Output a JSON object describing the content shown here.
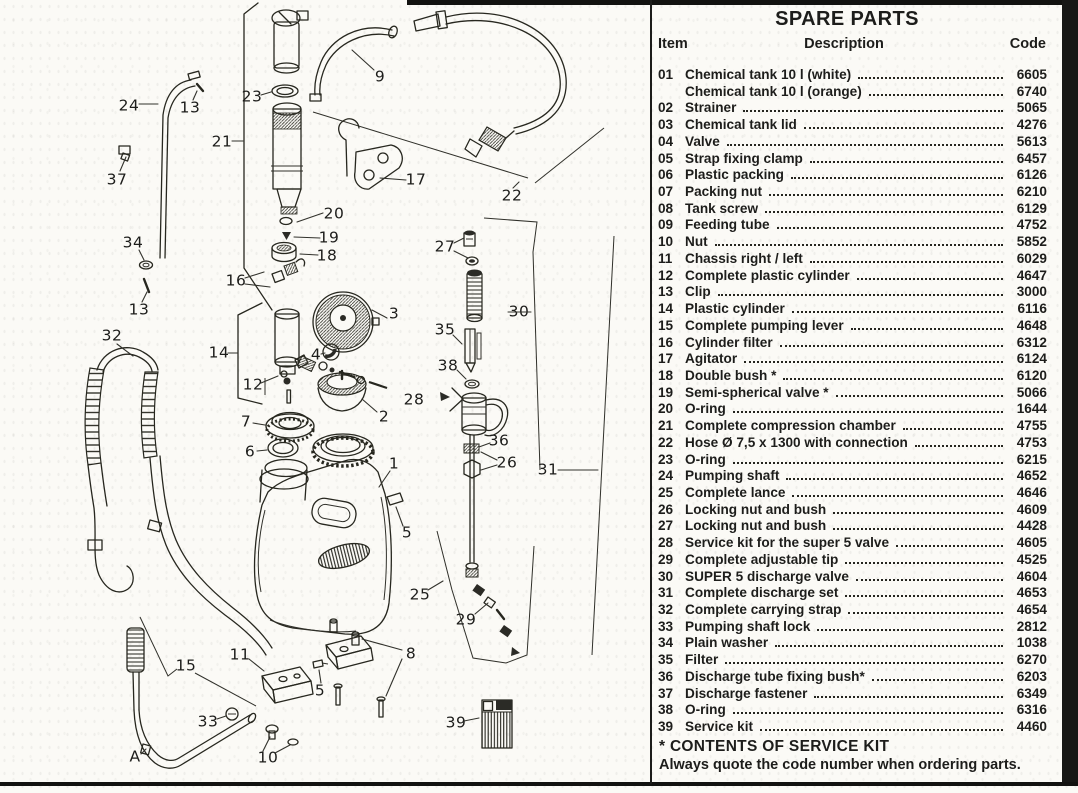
{
  "colors": {
    "ink": "#1d1d1b",
    "paper": "#fbfaf6"
  },
  "parts_table": {
    "title": "SPARE PARTS",
    "columns": {
      "item": "Item",
      "description": "Description",
      "code": "Code"
    },
    "rows": [
      {
        "item": "01",
        "description": "Chemical tank 10 l (white)",
        "code": "6605"
      },
      {
        "item": "",
        "description": "Chemical tank 10 l (orange)",
        "code": "6740"
      },
      {
        "item": "02",
        "description": "Strainer",
        "code": "5065"
      },
      {
        "item": "03",
        "description": "Chemical tank lid",
        "code": "4276"
      },
      {
        "item": "04",
        "description": "Valve",
        "code": "5613"
      },
      {
        "item": "05",
        "description": "Strap fixing clamp",
        "code": "6457"
      },
      {
        "item": "06",
        "description": "Plastic packing",
        "code": "6126"
      },
      {
        "item": "07",
        "description": "Packing nut",
        "code": "6210"
      },
      {
        "item": "08",
        "description": "Tank screw",
        "code": "6129"
      },
      {
        "item": "09",
        "description": "Feeding tube",
        "code": "4752"
      },
      {
        "item": "10",
        "description": "Nut",
        "code": "5852"
      },
      {
        "item": "11",
        "description": "Chassis right / left",
        "code": "6029"
      },
      {
        "item": "12",
        "description": "Complete plastic cylinder",
        "code": "4647"
      },
      {
        "item": "13",
        "description": "Clip",
        "code": "3000"
      },
      {
        "item": "14",
        "description": "Plastic cylinder",
        "code": "6116"
      },
      {
        "item": "15",
        "description": "Complete pumping lever",
        "code": "4648"
      },
      {
        "item": "16",
        "description": "Cylinder filter",
        "code": "6312"
      },
      {
        "item": "17",
        "description": "Agitator",
        "code": "6124"
      },
      {
        "item": "18",
        "description": "Double bush *",
        "code": "6120"
      },
      {
        "item": "19",
        "description": "Semi-spherical valve *",
        "code": "5066"
      },
      {
        "item": "20",
        "description": "O-ring",
        "code": "1644"
      },
      {
        "item": "21",
        "description": "Complete compression chamber",
        "code": "4755"
      },
      {
        "item": "22",
        "description": "Hose Ø 7,5 x 1300 with connection",
        "code": "4753"
      },
      {
        "item": "23",
        "description": "O-ring",
        "code": "6215"
      },
      {
        "item": "24",
        "description": "Pumping shaft",
        "code": "4652"
      },
      {
        "item": "25",
        "description": "Complete lance",
        "code": "4646"
      },
      {
        "item": "26",
        "description": "Locking nut and bush",
        "code": "4609"
      },
      {
        "item": "27",
        "description": "Locking nut and bush",
        "code": "4428"
      },
      {
        "item": "28",
        "description": "Service kit for the super 5 valve",
        "code": "4605"
      },
      {
        "item": "29",
        "description": "Complete adjustable tip",
        "code": "4525"
      },
      {
        "item": "30",
        "description": "SUPER 5 discharge valve",
        "code": "4604"
      },
      {
        "item": "31",
        "description": "Complete discharge set",
        "code": "4653"
      },
      {
        "item": "32",
        "description": "Complete carrying strap",
        "code": "4654"
      },
      {
        "item": "33",
        "description": "Pumping shaft lock",
        "code": "2812"
      },
      {
        "item": "34",
        "description": "Plain washer",
        "code": "1038"
      },
      {
        "item": "35",
        "description": "Filter",
        "code": "6270"
      },
      {
        "item": "36",
        "description": "Discharge tube fixing bush*",
        "code": "6203"
      },
      {
        "item": "37",
        "description": "Discharge fastener",
        "code": "6349"
      },
      {
        "item": "38",
        "description": "O-ring",
        "code": "6316"
      },
      {
        "item": "39",
        "description": "Service kit",
        "code": "4460"
      }
    ],
    "footnote": "* CONTENTS OF SERVICE KIT",
    "note": "Always quote the code number when ordering parts."
  },
  "diagram": {
    "callouts": [
      {
        "t": "24",
        "x": 129,
        "y": 106,
        "l": [
          [
            139,
            104
          ],
          [
            158,
            104
          ]
        ]
      },
      {
        "t": "13",
        "x": 190,
        "y": 108,
        "l": [
          [
            193,
            100
          ],
          [
            197,
            91
          ]
        ]
      },
      {
        "t": "37",
        "x": 117,
        "y": 180,
        "l": [
          [
            120,
            171
          ],
          [
            126,
            157
          ]
        ]
      },
      {
        "t": "21",
        "x": 222,
        "y": 142,
        "l": [
          [
            232,
            141
          ],
          [
            243,
            141
          ]
        ]
      },
      {
        "t": "23",
        "x": 252,
        "y": 97,
        "l": [
          [
            261,
            95
          ],
          [
            271,
            92
          ]
        ]
      },
      {
        "t": "9",
        "x": 380,
        "y": 77,
        "l": [
          [
            374,
            70
          ],
          [
            352,
            50
          ]
        ]
      },
      {
        "t": "17",
        "x": 416,
        "y": 180,
        "l": [
          [
            406,
            180
          ],
          [
            380,
            178
          ]
        ]
      },
      {
        "t": "22",
        "x": 512,
        "y": 196,
        "l": [
          [
            513,
            188
          ],
          [
            519,
            182
          ]
        ]
      },
      {
        "t": "20",
        "x": 334,
        "y": 214,
        "l": [
          [
            323,
            213
          ],
          [
            297,
            222
          ]
        ]
      },
      {
        "t": "19",
        "x": 329,
        "y": 238,
        "l": [
          [
            320,
            238
          ],
          [
            294,
            237
          ]
        ]
      },
      {
        "t": "18",
        "x": 327,
        "y": 256,
        "l": [
          [
            318,
            255
          ],
          [
            300,
            254
          ]
        ]
      },
      {
        "t": "34",
        "x": 133,
        "y": 243,
        "l": [
          [
            139,
            250
          ],
          [
            144,
            260
          ]
        ]
      },
      {
        "t": "16",
        "x": 236,
        "y": 281,
        "l": [
          [
            245,
            278
          ],
          [
            264,
            272
          ]
        ],
        "l2": [
          [
            245,
            284
          ],
          [
            270,
            287
          ]
        ]
      },
      {
        "t": "27",
        "x": 445,
        "y": 247,
        "l": [
          [
            454,
            243
          ],
          [
            464,
            238
          ]
        ],
        "l2": [
          [
            454,
            251
          ],
          [
            468,
            258
          ]
        ]
      },
      {
        "t": "13",
        "x": 139,
        "y": 310,
        "l": [
          [
            142,
            302
          ],
          [
            147,
            292
          ]
        ]
      },
      {
        "t": "32",
        "x": 112,
        "y": 336,
        "l": [
          [
            117,
            344
          ],
          [
            133,
            356
          ]
        ]
      },
      {
        "t": "14",
        "x": 219,
        "y": 353,
        "l": [
          [
            228,
            353
          ],
          [
            238,
            353
          ]
        ]
      },
      {
        "t": "12",
        "x": 253,
        "y": 385,
        "l": [
          [
            261,
            383
          ],
          [
            278,
            376
          ]
        ]
      },
      {
        "t": "3",
        "x": 394,
        "y": 314,
        "l": [
          [
            387,
            318
          ],
          [
            372,
            310
          ]
        ]
      },
      {
        "t": "4",
        "x": 316,
        "y": 355,
        "l": [
          [
            321,
            354
          ],
          [
            325,
            353
          ]
        ]
      },
      {
        "t": "35",
        "x": 445,
        "y": 330,
        "l": [
          [
            453,
            335
          ],
          [
            462,
            344
          ]
        ]
      },
      {
        "t": "38",
        "x": 448,
        "y": 366,
        "l": [
          [
            457,
            370
          ],
          [
            466,
            379
          ]
        ]
      },
      {
        "t": "30",
        "x": 519,
        "y": 312,
        "l": [
          [
            508,
            312
          ],
          [
            531,
            312
          ]
        ]
      },
      {
        "t": "2",
        "x": 384,
        "y": 417,
        "l": [
          [
            377,
            412
          ],
          [
            362,
            399
          ]
        ]
      },
      {
        "t": "7",
        "x": 246,
        "y": 422,
        "l": [
          [
            253,
            423
          ],
          [
            265,
            425
          ]
        ]
      },
      {
        "t": "6",
        "x": 250,
        "y": 452,
        "l": [
          [
            257,
            451
          ],
          [
            267,
            450
          ]
        ]
      },
      {
        "t": "28",
        "x": 414,
        "y": 400
      },
      {
        "t": "36",
        "x": 499,
        "y": 441,
        "l": [
          [
            490,
            443
          ],
          [
            479,
            447
          ]
        ]
      },
      {
        "t": "26",
        "x": 507,
        "y": 463,
        "l": [
          [
            497,
            460
          ],
          [
            481,
            452
          ]
        ],
        "l2": [
          [
            497,
            465
          ],
          [
            481,
            470
          ]
        ]
      },
      {
        "t": "1",
        "x": 394,
        "y": 464,
        "l": [
          [
            390,
            471
          ],
          [
            379,
            487
          ]
        ]
      },
      {
        "t": "31",
        "x": 548,
        "y": 470,
        "l": [
          [
            558,
            470
          ],
          [
            598,
            470
          ]
        ]
      },
      {
        "t": "5",
        "x": 407,
        "y": 533,
        "l": [
          [
            403,
            526
          ],
          [
            396,
            507
          ]
        ]
      },
      {
        "t": "25",
        "x": 420,
        "y": 595,
        "l": [
          [
            428,
            590
          ],
          [
            443,
            581
          ]
        ]
      },
      {
        "t": "29",
        "x": 466,
        "y": 620,
        "l": [
          [
            475,
            614
          ],
          [
            488,
            603
          ]
        ]
      },
      {
        "t": "15",
        "x": 186,
        "y": 666
      },
      {
        "t": "33",
        "x": 208,
        "y": 722,
        "l": [
          [
            217,
            719
          ],
          [
            226,
            716
          ]
        ]
      },
      {
        "t": "11",
        "x": 240,
        "y": 655,
        "l": [
          [
            249,
            659
          ],
          [
            264,
            671
          ]
        ]
      },
      {
        "t": "8",
        "x": 411,
        "y": 654,
        "l": [
          [
            402,
            650
          ],
          [
            362,
            639
          ]
        ],
        "l2": [
          [
            402,
            659
          ],
          [
            386,
            696
          ]
        ]
      },
      {
        "t": "5",
        "x": 320,
        "y": 691,
        "l": [
          [
            321,
            683
          ],
          [
            319,
            670
          ]
        ]
      },
      {
        "t": "10",
        "x": 268,
        "y": 758,
        "l": [
          [
            263,
            751
          ],
          [
            270,
            737
          ]
        ],
        "l2": [
          [
            275,
            753
          ],
          [
            290,
            745
          ]
        ]
      },
      {
        "t": "39",
        "x": 456,
        "y": 723,
        "l": [
          [
            464,
            721
          ],
          [
            479,
            718
          ]
        ]
      },
      {
        "t": "A",
        "x": 135,
        "y": 757,
        "l": [
          [
            141,
            754
          ],
          [
            146,
            749
          ]
        ]
      }
    ]
  }
}
